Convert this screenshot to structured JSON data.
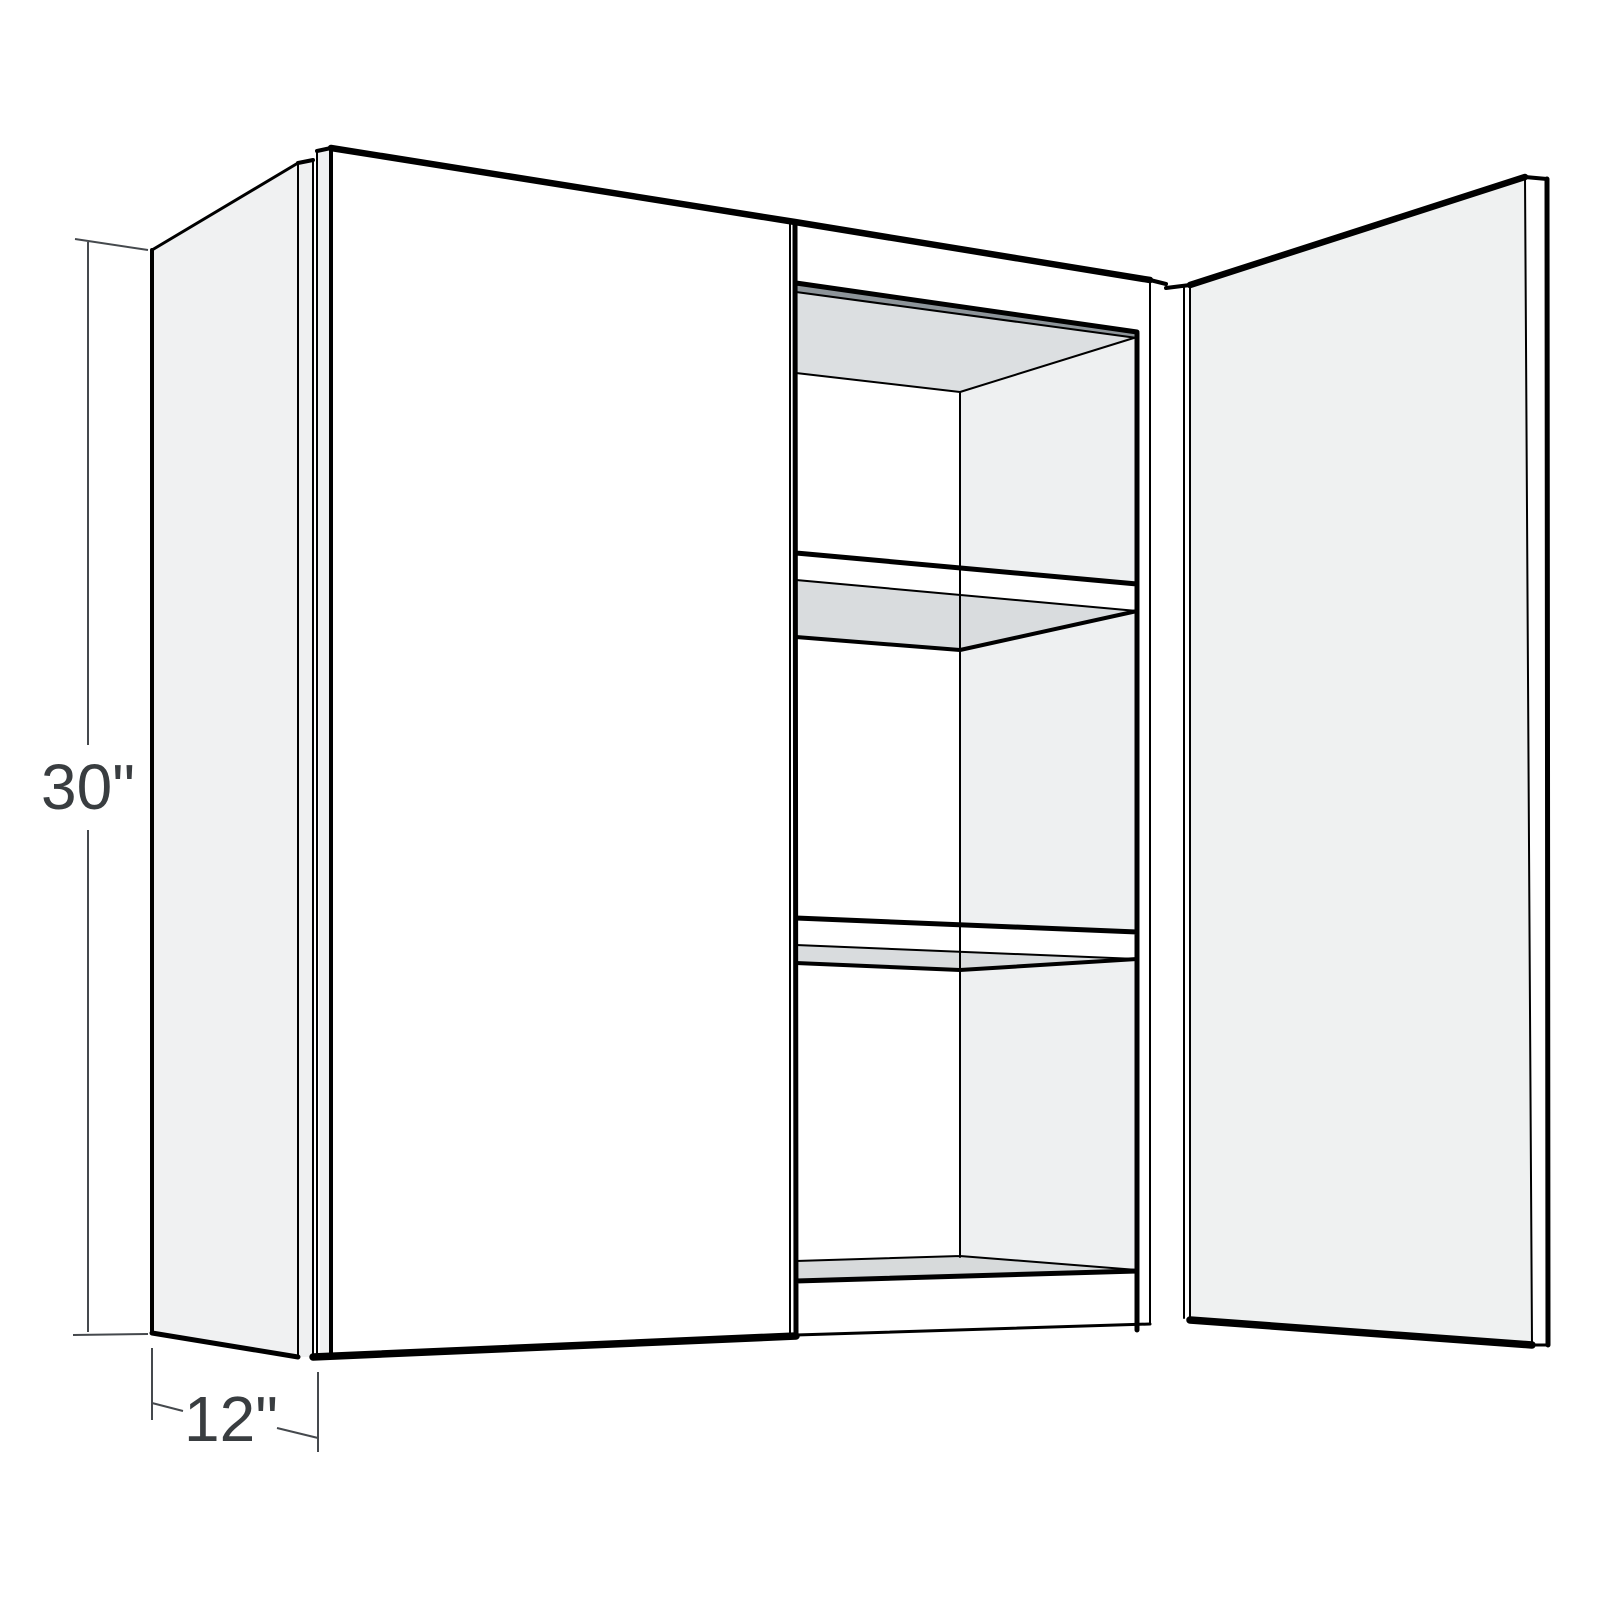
{
  "figure": {
    "type": "product-dimension-diagram",
    "subject": "two-door wall cabinet, right door open, three interior shelf openings",
    "dimensions": {
      "height": {
        "label": "30\"",
        "value": 30,
        "unit": "in"
      },
      "depth": {
        "label": "12\"",
        "value": 12,
        "unit": "in"
      }
    },
    "colors": {
      "background": "#ffffff",
      "line": "#000000",
      "dimension_line": "#45494d",
      "dimension_text": "#393d40",
      "side_panel": "#f0f1f2",
      "panel_edge": "#eff0f1",
      "door_face": "#ffffff",
      "open_door_inner": "#eff1f1",
      "interior_right_wall": "#eef0f1",
      "interior_back_wall": "#ffffff",
      "ceiling_underside": "#dcdfe1",
      "shelf_underside": "#d9dcde",
      "floor_top": "#d7dadb",
      "hanging_rail": "#8d9499"
    }
  }
}
